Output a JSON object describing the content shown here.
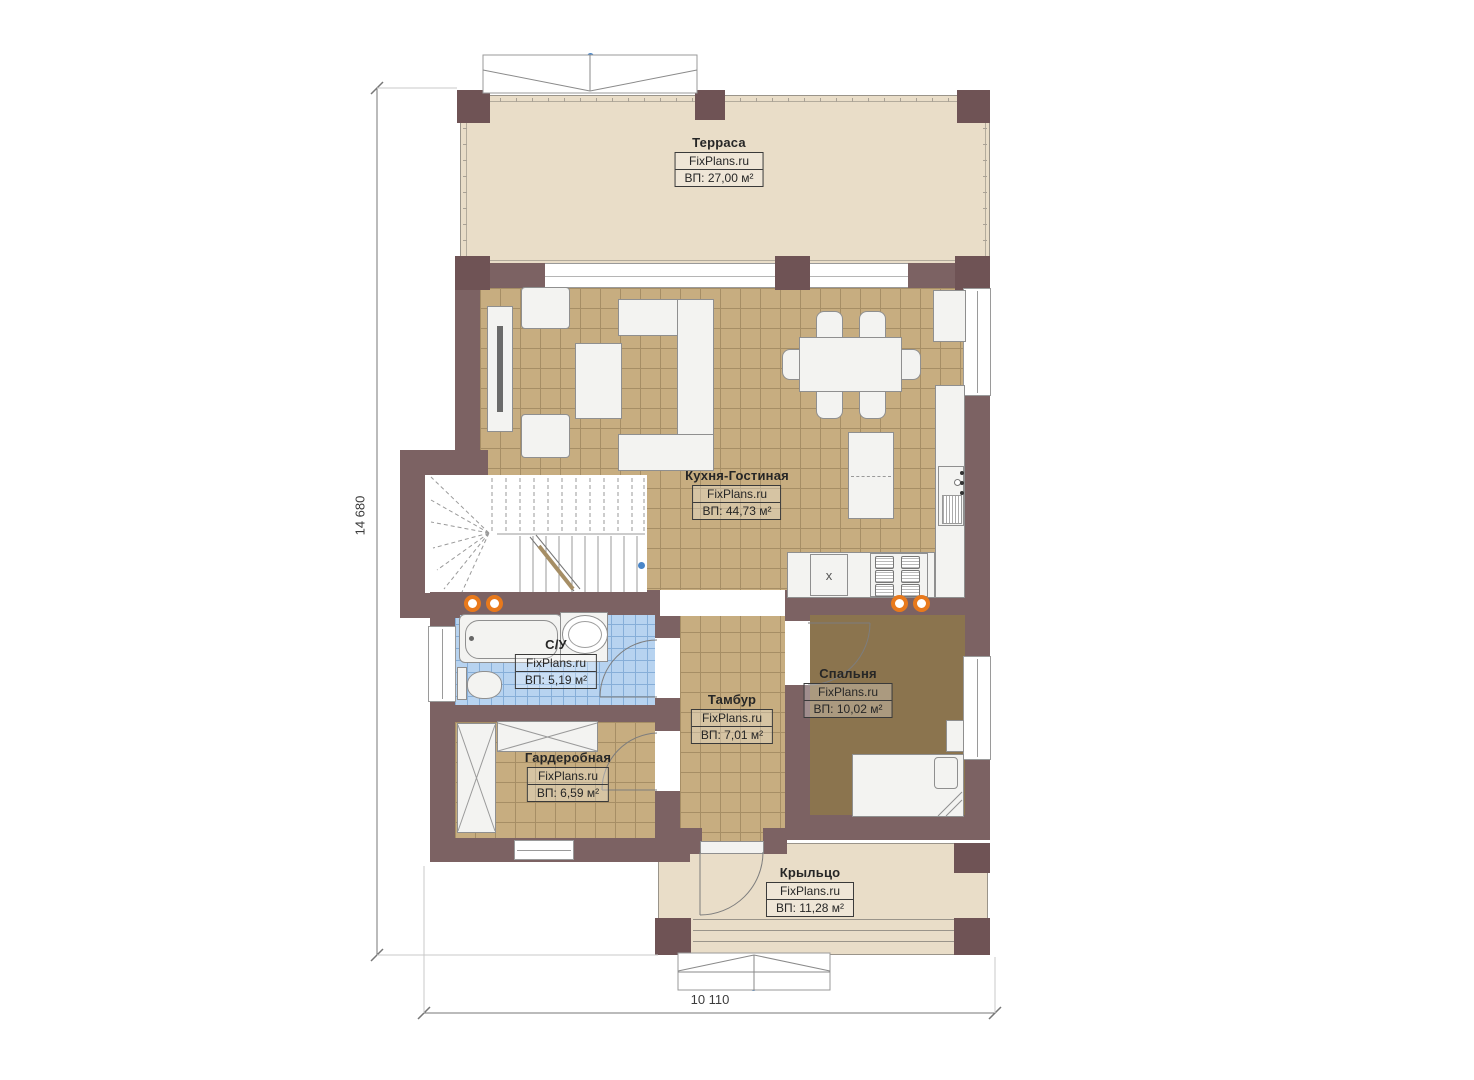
{
  "colors": {
    "wall": "#7c6263",
    "wall-dark": "#6f5355",
    "terrace-floor": "#e9ddc8",
    "tile-floor": "#c7ad80",
    "tile-grid": "#a68e65",
    "bedroom-floor": "#8b744e",
    "bath-floor": "#b7d3f0",
    "bath-grid": "#86aed8",
    "furniture": "#f3f3f1",
    "furniture-border": "#8f8f8f",
    "accent-orange": "#e8791c",
    "accent-blue": "#4a86c8"
  },
  "rooms": [
    {
      "name": "Терраса",
      "brand": "FixPlans.ru",
      "area": "ВП: 27,00 м²"
    },
    {
      "name": "Кухня-Гостиная",
      "brand": "FixPlans.ru",
      "area": "ВП: 44,73 м²"
    },
    {
      "name": "С/У",
      "brand": "FixPlans.ru",
      "area": "ВП: 5,19 м²"
    },
    {
      "name": "Тамбур",
      "brand": "FixPlans.ru",
      "area": "ВП: 7,01 м²"
    },
    {
      "name": "Спальня",
      "brand": "FixPlans.ru",
      "area": "ВП: 10,02 м²"
    },
    {
      "name": "Гардеробная",
      "brand": "FixPlans.ru",
      "area": "ВП: 6,59 м²"
    },
    {
      "name": "Крыльцо",
      "brand": "FixPlans.ru",
      "area": "ВП: 11,28 м²"
    }
  ],
  "dimensions": {
    "vertical": "14 680",
    "horizontal": "10 110"
  },
  "symbols": {
    "stove_marker": "x"
  }
}
